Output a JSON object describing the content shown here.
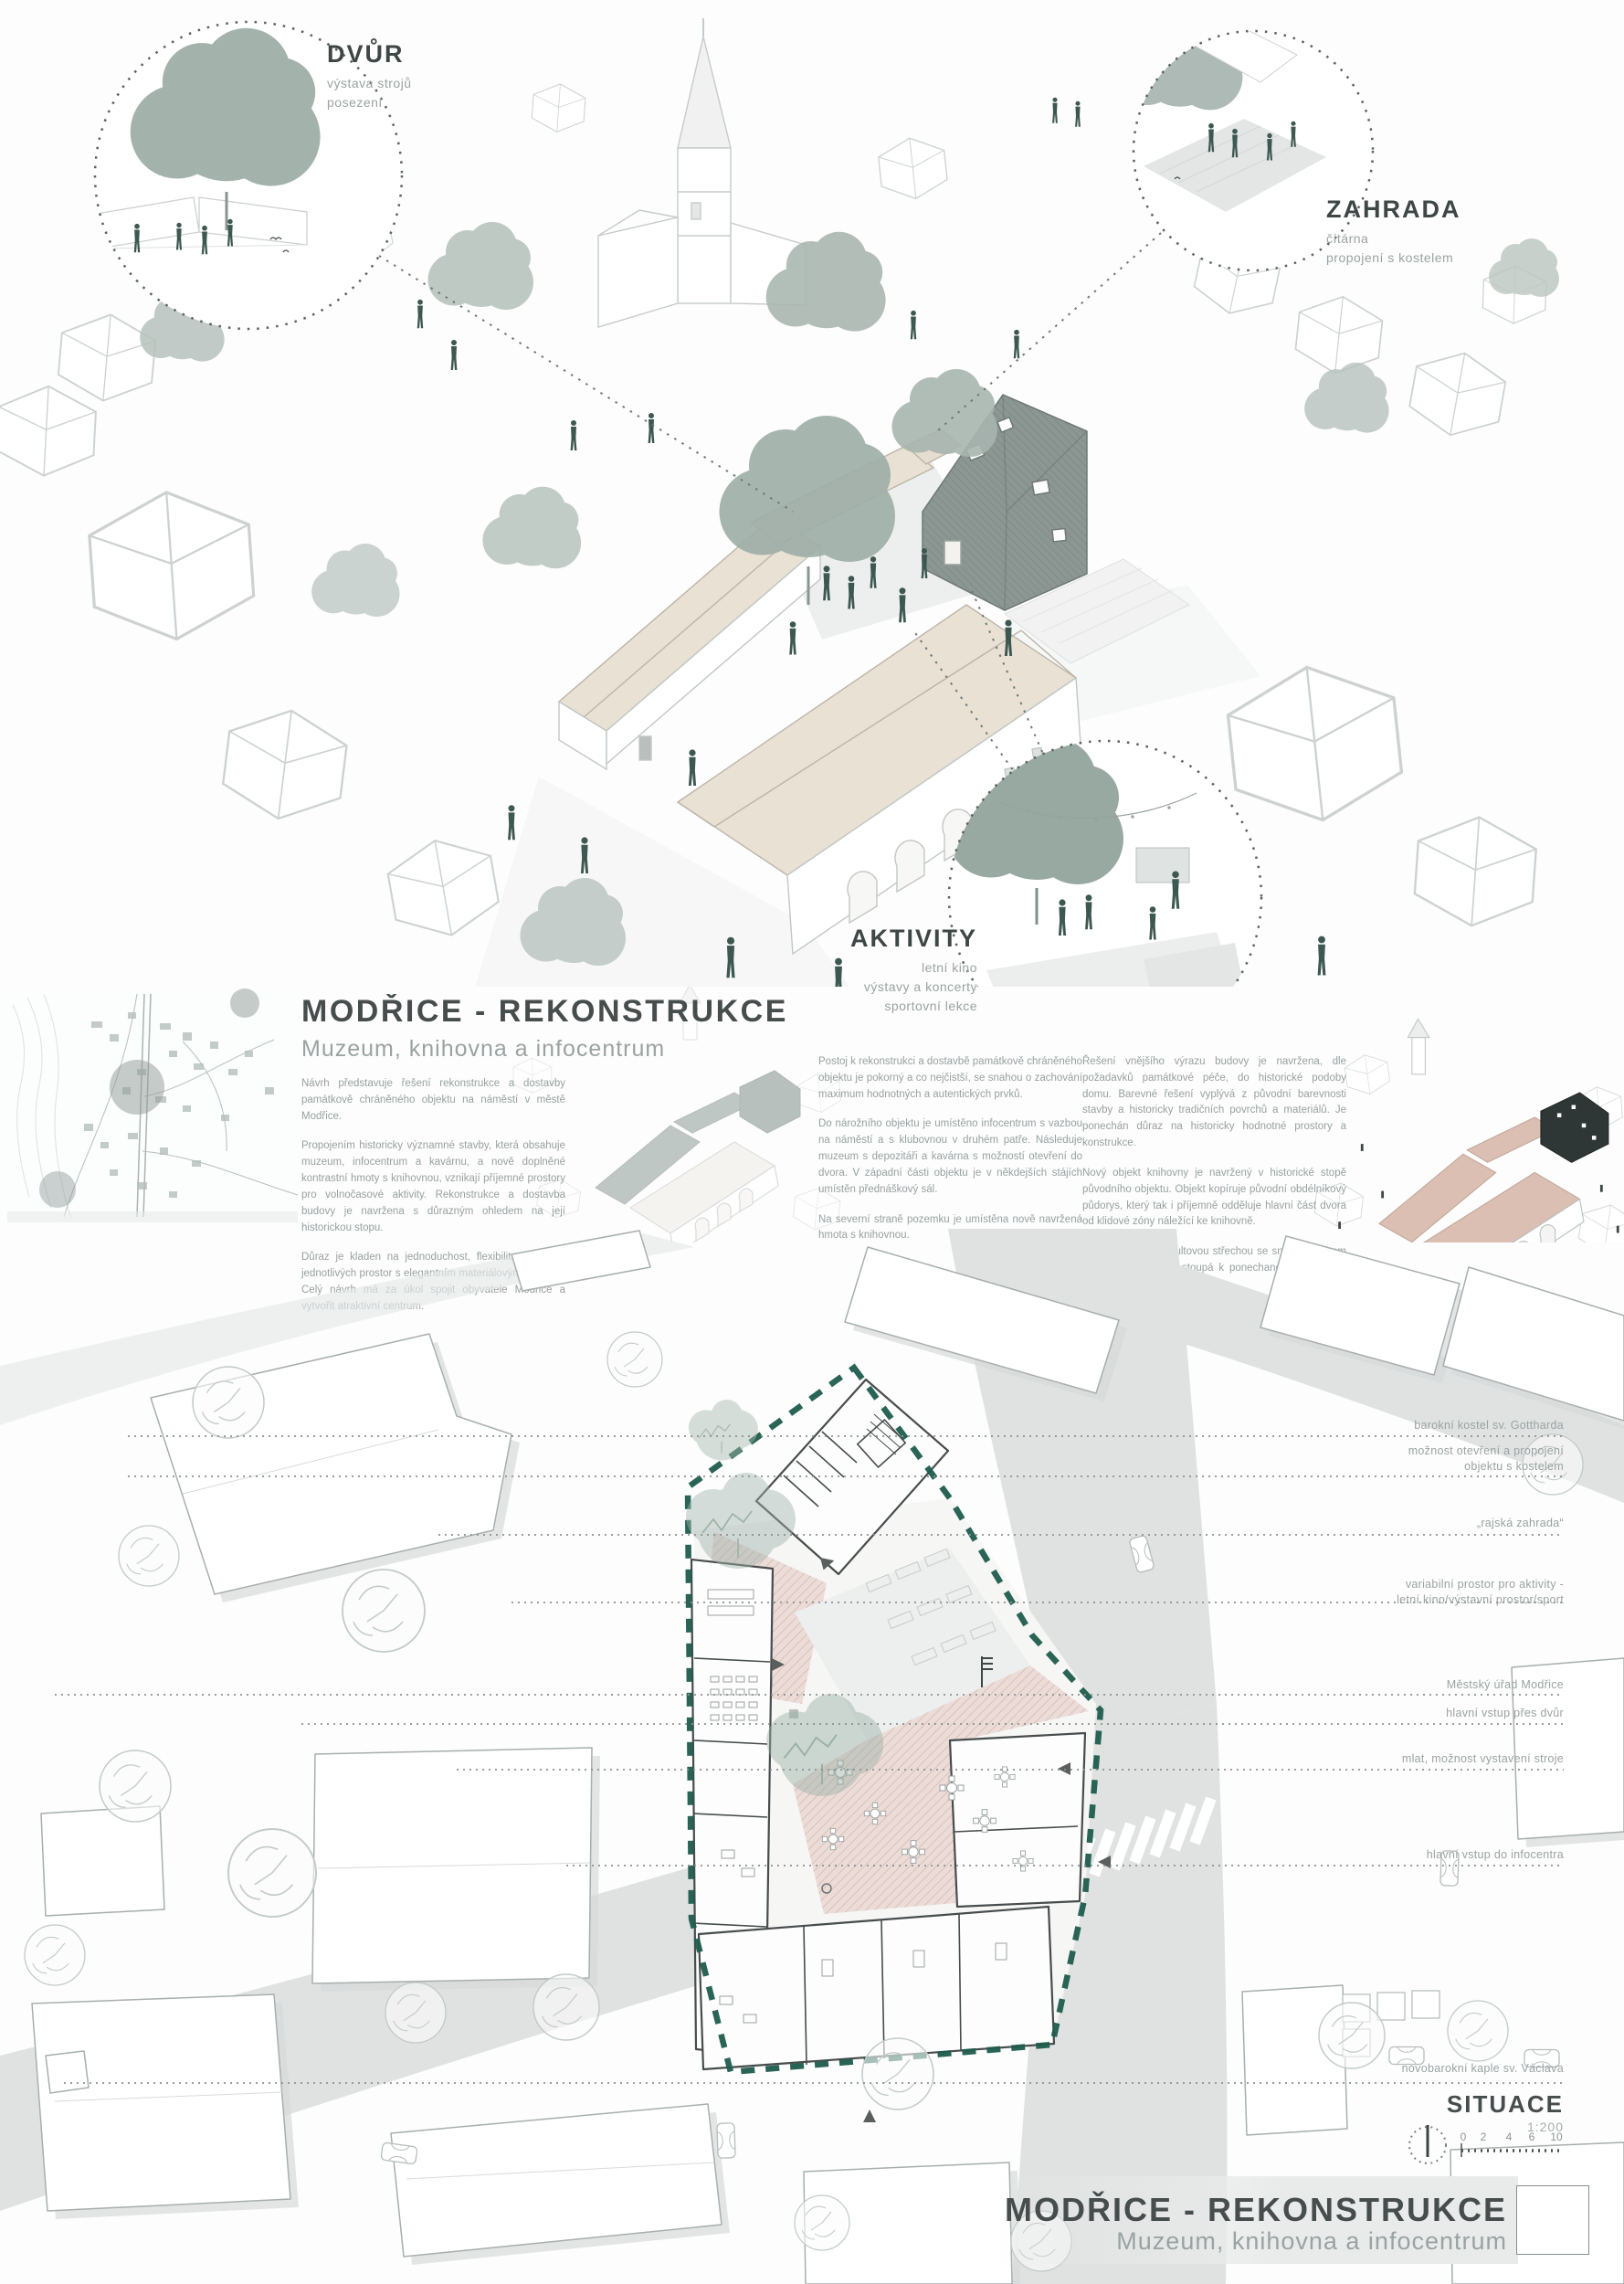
{
  "callouts": {
    "dvur": {
      "title": "DVŮR",
      "lines": [
        "výstava strojů",
        "posezení"
      ]
    },
    "zahrada": {
      "title": "ZAHRADA",
      "lines": [
        "čítárna",
        "propojení s kostelem"
      ]
    },
    "aktivity": {
      "title": "AKTIVITY",
      "lines": [
        "letní kino",
        "výstavy a koncerty",
        "sportovní lekce"
      ]
    }
  },
  "header": {
    "title": "MODŘICE - REKONSTRUKCE",
    "subtitle": "Muzeum, knihovna a infocentrum"
  },
  "columns": {
    "left": [
      "Návrh představuje řešení rekonstrukce a dostavby památkově chráněného objektu na náměstí v městě Modřice.",
      "Propojením historicky významné stavby, která obsahuje muzeum, infocentrum a kavárnu, a nově doplněné kontrastní hmoty s knihovnou, vznikají příjemné prostory pro volnočasové aktivity. Rekonstrukce a dostavba budovy je navržena s důrazným ohledem na její historickou stopu.",
      "Důraz je kladen na jednoduchost, flexibilitu a čistotu jednotlivých prostor s elegantním materiálovým řešením. Celý návrh má za úkol spojit obyvatele Modřice a vytvořit atraktivní centrum."
    ],
    "middle": [
      "Postoj k rekonstrukci a dostavbě památkově chráněného objektu je pokorný a co nejčistší, se snahou o zachování maximum hodnotných a autentických prvků.",
      "Do nárožního objektu je umístěno infocentrum s vazbou na náměstí a s klubovnou v druhém patře. Následuje muzeum s depozitáři a kavárna s možností otevření do dvora. V západní části objektu je v někdejších stájích umístěn přednáškový sál.",
      "Na severní straně pozemku je umístěna nově navržená hmota s knihovnou."
    ],
    "right": [
      "Řešení vnějšího výrazu budovy je navržena, dle požadavků památkové péče, do historické podoby domu. Barevné řešení vyplývá z původní barevnosti stavby a historicky tradičních povrchů a materiálů. Je ponechán důraz na historicky hodnotné prostory a konstrukce.",
      "Nový objekt knihovny je navržený v historické stopě původního objektu. Objekt kopíruje původní obdélníkový půdorys, který tak i příjemně odděluje hlavní část dvora od klidové zóny náležící ke knihovně.",
      "Hmota se šikmou pultovou střechou se snižuje směrem do dvora a naopak stoupá k ponechané stěně tvořící původní štít domu."
    ]
  },
  "siteplan": {
    "annotations": [
      {
        "lines": [
          "barokní kostel sv. Gottharda"
        ]
      },
      {
        "lines": [
          "možnost otevření a propojení",
          "objektu s kostelem"
        ]
      },
      {
        "lines": [
          "„rajská zahrada“"
        ]
      },
      {
        "lines": [
          "variabilní prostor pro aktivity -",
          "letní kino/výstavní prostor/sport"
        ]
      },
      {
        "lines": [
          "Městský úřad Modřice"
        ]
      },
      {
        "lines": [
          "hlavní vstup přes dvůr"
        ]
      },
      {
        "lines": [
          "mlat, možnost vystavení stroje"
        ]
      },
      {
        "lines": [
          "hlavní vstup do infocentra"
        ]
      },
      {
        "lines": [
          "novobarokní kaple sv. Václava"
        ]
      }
    ],
    "title": "SITUACE",
    "scale": "1:200",
    "scalebar": [
      "0",
      "2",
      "4",
      "6",
      "10"
    ]
  },
  "footer": {
    "title": "MODŘICE - REKONSTRUKCE",
    "subtitle": "Muzeum, knihovna a infocentrum"
  },
  "colors": {
    "accent_teal": "#1d5c4d",
    "roof_beige": "#e8e1d4",
    "roof_pink": "#dabfb2",
    "library_dark": "#2f3636",
    "figure_teal": "#3d5751",
    "text_dark": "#474d4d",
    "text_gray": "#98a1a0"
  }
}
